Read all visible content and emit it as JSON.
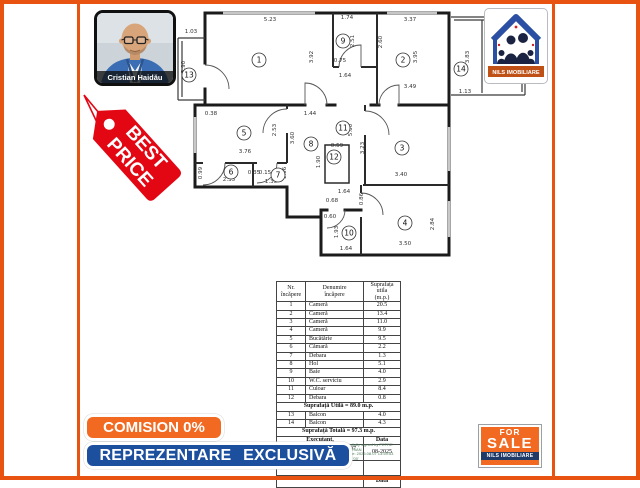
{
  "branding": {
    "agent_name": "Cristian Haidău",
    "agency_name": "NILS IMOBILIARE",
    "best_price_line1": "BEST",
    "best_price_line2": "PRICE",
    "commission_banner": "COMISION 0%",
    "exclusive_banner": "REPREZENTARE EXCLUSIVĂ",
    "for_sale_line1": "FOR",
    "for_sale_line2": "SALE",
    "for_sale_agency": "NILS IMOBILIARE",
    "colors": {
      "frame_orange": "#e95312",
      "banner_orange": "#f26a21",
      "banner_blue": "#1d4f9f",
      "tag_red": "#e30613",
      "logo_navy": "#1a2342",
      "logo_blue": "#2b4fa2"
    }
  },
  "plan": {
    "rooms": [
      {
        "n": "1",
        "x": 84,
        "y": 55
      },
      {
        "n": "2",
        "x": 228,
        "y": 55
      },
      {
        "n": "3",
        "x": 227,
        "y": 143
      },
      {
        "n": "4",
        "x": 230,
        "y": 218
      },
      {
        "n": "5",
        "x": 69,
        "y": 128
      },
      {
        "n": "6",
        "x": 56,
        "y": 167
      },
      {
        "n": "7",
        "x": 103,
        "y": 170
      },
      {
        "n": "8",
        "x": 136,
        "y": 139
      },
      {
        "n": "9",
        "x": 168,
        "y": 36
      },
      {
        "n": "10",
        "x": 174,
        "y": 228
      },
      {
        "n": "11",
        "x": 168,
        "y": 123
      },
      {
        "n": "12",
        "x": 159,
        "y": 152
      },
      {
        "n": "13",
        "x": 14,
        "y": 70
      },
      {
        "n": "14",
        "x": 286,
        "y": 64
      }
    ],
    "dims": [
      {
        "t": "1.03",
        "x": 16,
        "y": 28,
        "r": 0
      },
      {
        "t": "3.90",
        "x": 10,
        "y": 62,
        "r": -90
      },
      {
        "t": "5.23",
        "x": 95,
        "y": 16,
        "r": 0
      },
      {
        "t": "3.92",
        "x": 138,
        "y": 52,
        "r": -90
      },
      {
        "t": "1.74",
        "x": 172,
        "y": 14,
        "r": 0
      },
      {
        "t": "2.51",
        "x": 179,
        "y": 36,
        "r": -90
      },
      {
        "t": "0.75",
        "x": 165,
        "y": 57,
        "r": 0
      },
      {
        "t": "2.60",
        "x": 207,
        "y": 37,
        "r": -90
      },
      {
        "t": "3.37",
        "x": 235,
        "y": 16,
        "r": 0
      },
      {
        "t": "3.95",
        "x": 242,
        "y": 52,
        "r": -90
      },
      {
        "t": "3.49",
        "x": 235,
        "y": 83,
        "r": 0
      },
      {
        "t": "3.83",
        "x": 294,
        "y": 52,
        "r": -90
      },
      {
        "t": "1.13",
        "x": 290,
        "y": 88,
        "r": 0
      },
      {
        "t": "1.64",
        "x": 170,
        "y": 72,
        "r": 0
      },
      {
        "t": "0.38",
        "x": 36,
        "y": 110,
        "r": 0
      },
      {
        "t": "1.44",
        "x": 135,
        "y": 110,
        "r": 0
      },
      {
        "t": "3.76",
        "x": 70,
        "y": 148,
        "r": 0
      },
      {
        "t": "2.53",
        "x": 101,
        "y": 125,
        "r": -90
      },
      {
        "t": "3.60",
        "x": 119,
        "y": 133,
        "r": -90
      },
      {
        "t": "5.00",
        "x": 177,
        "y": 125,
        "r": -90
      },
      {
        "t": "1.90",
        "x": 145,
        "y": 157,
        "r": -90
      },
      {
        "t": "0.99",
        "x": 27,
        "y": 168,
        "r": -90
      },
      {
        "t": "2.35",
        "x": 54,
        "y": 176,
        "r": 0
      },
      {
        "t": "0.35",
        "x": 79,
        "y": 169,
        "r": 0
      },
      {
        "t": "0.15",
        "x": 90,
        "y": 169,
        "r": 0
      },
      {
        "t": "1.35",
        "x": 96,
        "y": 178,
        "r": 0
      },
      {
        "t": "1.06",
        "x": 111,
        "y": 168,
        "r": -90
      },
      {
        "t": "0.59",
        "x": 162,
        "y": 142,
        "r": 0
      },
      {
        "t": "3.23",
        "x": 189,
        "y": 143,
        "r": -90
      },
      {
        "t": "3.40",
        "x": 226,
        "y": 171,
        "r": 0
      },
      {
        "t": "0.86",
        "x": 188,
        "y": 194,
        "r": -90
      },
      {
        "t": "1.64",
        "x": 169,
        "y": 188,
        "r": 0
      },
      {
        "t": "0.68",
        "x": 157,
        "y": 197,
        "r": 0
      },
      {
        "t": "0.60",
        "x": 155,
        "y": 213,
        "r": 0
      },
      {
        "t": "1.93",
        "x": 163,
        "y": 227,
        "r": -90
      },
      {
        "t": "1.64",
        "x": 171,
        "y": 245,
        "r": 0
      },
      {
        "t": "2.84",
        "x": 259,
        "y": 219,
        "r": -90
      },
      {
        "t": "3.50",
        "x": 230,
        "y": 240,
        "r": 0
      }
    ]
  },
  "table": {
    "headers": [
      "Nr.\nîncăpere",
      "Denumire\nîncăpere",
      "Suprafața\nutila\n(m.p.)"
    ],
    "rows": [
      [
        "1",
        "Cameră",
        "20.5"
      ],
      [
        "2",
        "Cameră",
        "13.4"
      ],
      [
        "3",
        "Cameră",
        "11.0"
      ],
      [
        "4",
        "Cameră",
        "9.9"
      ],
      [
        "5",
        "Bucătărie",
        "9.5"
      ],
      [
        "6",
        "Cămară",
        "2.2"
      ],
      [
        "7",
        "Debara",
        "1.3"
      ],
      [
        "8",
        "Hol",
        "5.1"
      ],
      [
        "9",
        "Baie",
        "4.0"
      ],
      [
        "10",
        "W.C. serviciu",
        "2.9"
      ],
      [
        "11",
        "Culoar",
        "8.4"
      ],
      [
        "12",
        "Debara",
        "0.8"
      ]
    ],
    "subtotal": "Suprafață Utilă = 89.0 m.p.",
    "balcony_rows": [
      [
        "13",
        "Balcon",
        "4.0"
      ],
      [
        "14",
        "Balcon",
        "4.3"
      ]
    ],
    "total": "Suprafață Totală = 97.3 m.p.",
    "executant_label": "Executant,",
    "data_label": "Data",
    "executant_lines": "Aut. Seria RO-MB-F nr. 0107\nPetre Marian",
    "date_value": "08-2025",
    "signature_lines": "Digitally signed by PETRE\nMARIAN\nDate: 2025.08.07 13:59:53\n+03'00'",
    "bottom_data_label": "Data"
  }
}
